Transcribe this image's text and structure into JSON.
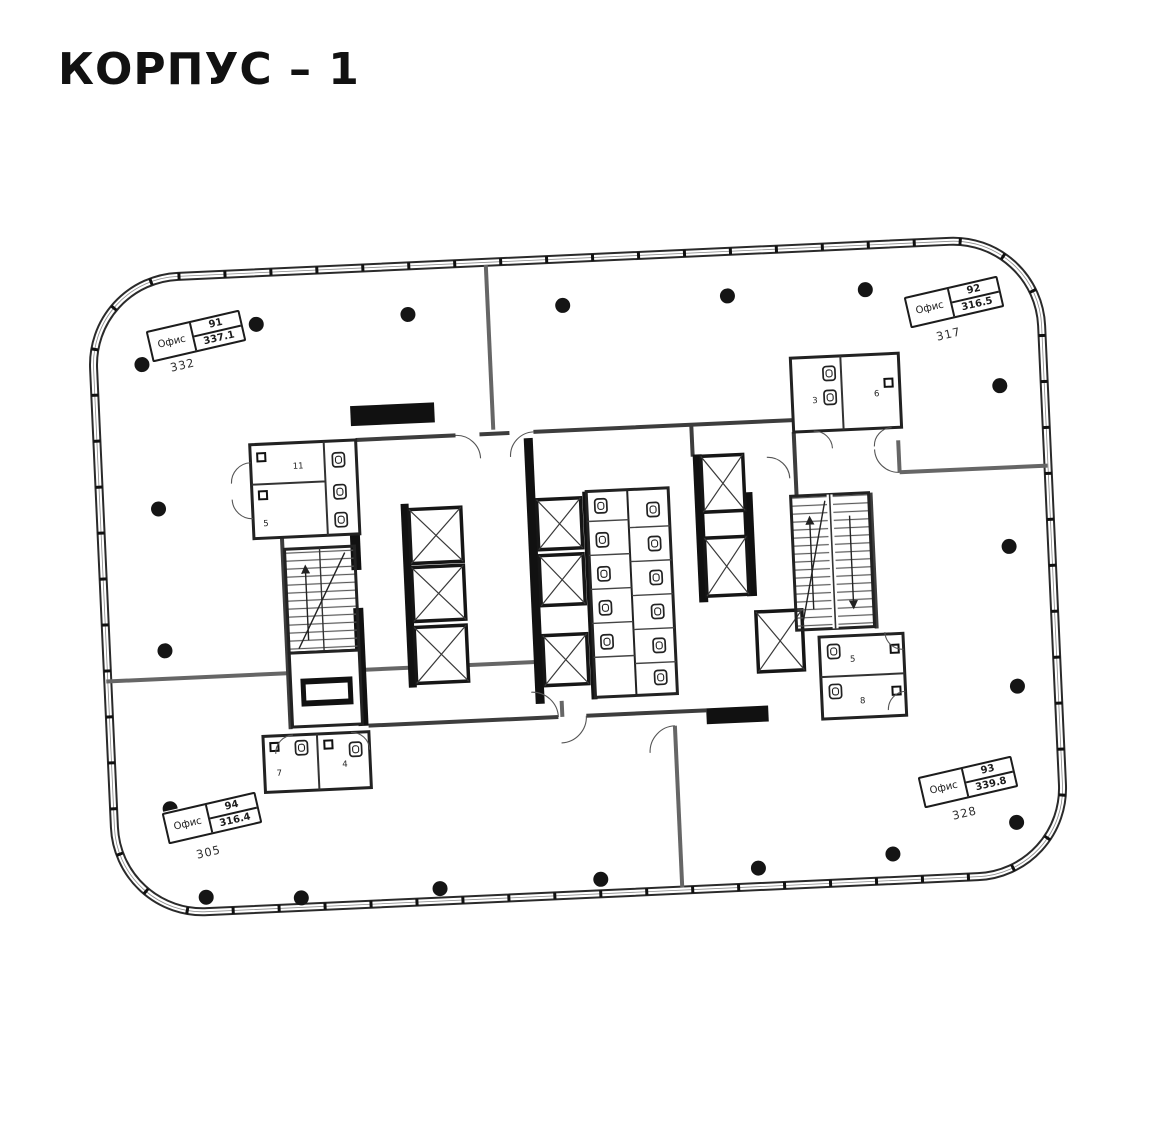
{
  "title": "КОРПУС – 1",
  "offices": [
    {
      "label": "Офис",
      "id": "91",
      "area": "337.1",
      "room": "332"
    },
    {
      "label": "Офис",
      "id": "92",
      "area": "316.5",
      "room": "317"
    },
    {
      "label": "Офис",
      "id": "93",
      "area": "339.8",
      "room": "328"
    },
    {
      "label": "Офис",
      "id": "94",
      "area": "316.4",
      "room": "305"
    }
  ],
  "core_rooms": {
    "top_left_a": "11",
    "top_left_b": "5",
    "top_right_a": "3",
    "top_right_b": "6",
    "bottom_left_a": "7",
    "bottom_left_b": "4",
    "bottom_right_a": "5",
    "bottom_right_b": "8"
  },
  "colors": {
    "ink": "#1c1c1c",
    "wall_gray": "#4a4a4a",
    "paper": "#ffffff"
  }
}
